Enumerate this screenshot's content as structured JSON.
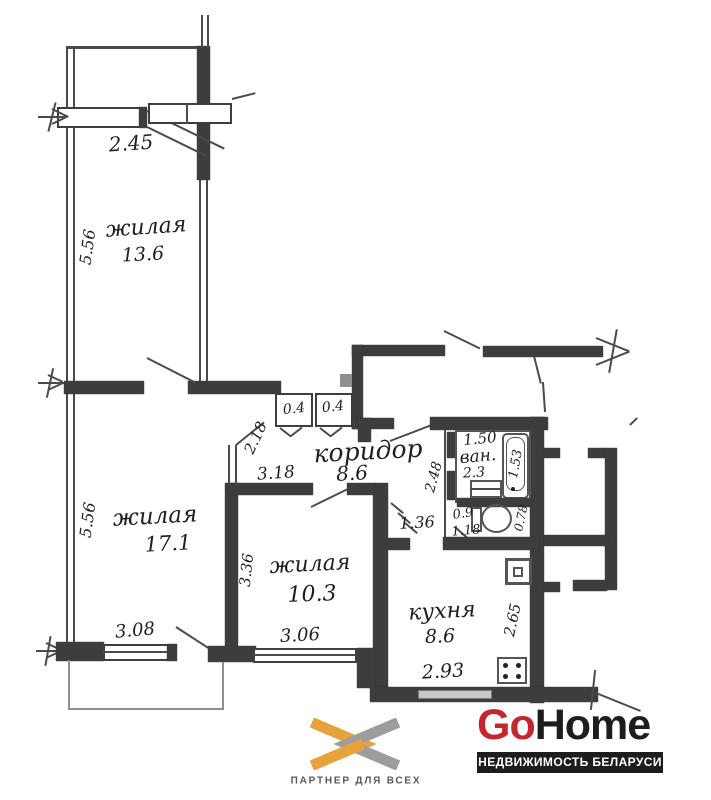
{
  "floor_plan": {
    "rooms": {
      "living_top": {
        "name": "жилая",
        "area": "13.6"
      },
      "living_left": {
        "name": "жилая",
        "area": "17.1"
      },
      "living_small": {
        "name": "жилая",
        "area": "10.3"
      },
      "corridor": {
        "name": "коридор",
        "area": "8.6"
      },
      "bathroom": {
        "name": "ван.",
        "area": "2.3"
      },
      "kitchen": {
        "name": "кухня",
        "area": "8.6"
      }
    },
    "dimensions": {
      "top_room_width": "2.45",
      "top_room_depth": "5.56",
      "left_room_depth": "5.56",
      "closet_left": "0.4",
      "closet_right": "0.4",
      "corridor_entry": "2.18",
      "corridor_width": "3.18",
      "kitchen_doorway": "1.36",
      "bath_width": "1.50",
      "bath_tub_length": "1.53",
      "hall_niche": "2.48",
      "wc_width": "0.9",
      "wc_length": "1.18",
      "wc_depth": "0.78",
      "small_room_depth": "3.36",
      "small_room_width": "3.06",
      "left_room_window": "3.08",
      "kitchen_width": "2.93",
      "kitchen_depth": "2.65"
    }
  },
  "branding": {
    "partner": {
      "tagline": "ПАРТНЕР ДЛЯ ВСЕХ",
      "color_orange": "#E9A23B",
      "color_gray": "#9D9D9D"
    },
    "gohome": {
      "part1": "Go",
      "part2": "Home",
      "subtitle": "НЕДВИЖИМОСТЬ БЕЛАРУСИ",
      "color_red": "#C5262C",
      "color_dark": "#1D1D1B"
    }
  }
}
